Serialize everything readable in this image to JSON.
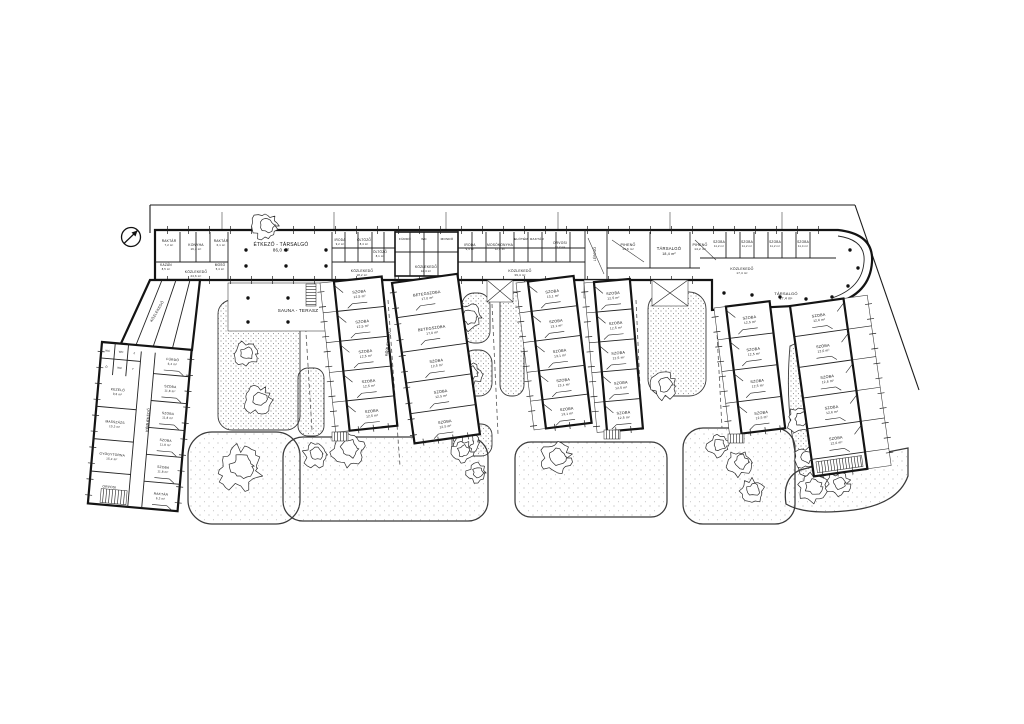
{
  "plan": {
    "ink": "#141414",
    "background": "#ffffff",
    "north_arrow": {
      "x": 131,
      "y": 237,
      "r": 9.5
    },
    "boundary": [
      [
        150,
        205,
        855,
        205
      ],
      [
        855,
        205,
        919,
        390
      ],
      [
        150,
        205,
        150,
        233
      ]
    ],
    "ext_lines": [
      [
        222,
        212,
        222,
        230
      ],
      [
        334,
        212,
        334,
        230
      ],
      [
        446,
        212,
        446,
        230
      ],
      [
        558,
        212,
        558,
        230
      ],
      [
        670,
        212,
        670,
        230
      ],
      [
        782,
        212,
        782,
        230
      ]
    ],
    "lawns": [
      {
        "x": 188,
        "y": 432,
        "w": 112,
        "h": 92,
        "rx": 24
      },
      {
        "x": 283,
        "y": 437,
        "w": 205,
        "h": 84,
        "rx": 20
      },
      {
        "x": 515,
        "y": 442,
        "w": 152,
        "h": 75,
        "rx": 16
      },
      {
        "x": 683,
        "y": 428,
        "w": 112,
        "h": 96,
        "rx": 20
      },
      {
        "path": "M786,504 Q782,478 800,470 Q846,458 888,452 L908,448 L908,476 Q898,504 854,510 Q806,516 786,504 Z"
      }
    ],
    "beds": [
      {
        "x": 218,
        "y": 300,
        "w": 82,
        "h": 130,
        "rx": 14
      },
      {
        "x": 298,
        "y": 368,
        "w": 26,
        "h": 68,
        "rx": 10
      },
      {
        "x": 462,
        "y": 293,
        "w": 28,
        "h": 50,
        "rx": 12
      },
      {
        "x": 462,
        "y": 350,
        "w": 30,
        "h": 46,
        "rx": 13
      },
      {
        "x": 452,
        "y": 424,
        "w": 40,
        "h": 32,
        "rx": 11
      },
      {
        "x": 500,
        "y": 292,
        "w": 24,
        "h": 104,
        "rx": 11
      },
      {
        "x": 648,
        "y": 292,
        "w": 58,
        "h": 104,
        "rx": 17
      },
      {
        "path": "M790,346 Q806,338 814,344 L838,470 Q816,482 800,474 Q784,414 790,346 Z"
      }
    ],
    "dashes": [
      [
        304,
        300,
        312,
        430
      ],
      [
        388,
        300,
        400,
        466
      ],
      [
        492,
        304,
        498,
        434
      ],
      [
        636,
        300,
        642,
        430
      ],
      [
        716,
        314,
        722,
        428
      ]
    ],
    "trees": [
      [
        246,
        354,
        12,
        0
      ],
      [
        258,
        400,
        14,
        0
      ],
      [
        468,
        318,
        14,
        0
      ],
      [
        470,
        374,
        12,
        0
      ],
      [
        466,
        442,
        12,
        0
      ],
      [
        664,
        386,
        13,
        0
      ],
      [
        800,
        420,
        13,
        0
      ],
      [
        806,
        458,
        11,
        0
      ],
      [
        240,
        468,
        22,
        0
      ],
      [
        315,
        455,
        12,
        0
      ],
      [
        348,
        450,
        16,
        0
      ],
      [
        462,
        452,
        11,
        0
      ],
      [
        477,
        473,
        10,
        0
      ],
      [
        556,
        458,
        15,
        0
      ],
      [
        718,
        446,
        11,
        0
      ],
      [
        740,
        463,
        13,
        0
      ],
      [
        752,
        491,
        12,
        0
      ],
      [
        812,
        488,
        15,
        0
      ],
      [
        838,
        484,
        12,
        0
      ],
      [
        265,
        226,
        14,
        1
      ]
    ],
    "slab": {
      "outline": "M155,230 L838,230 Q874,234 872,262 Q870,294 834,304 L712,310 L712,280 L155,280 Z",
      "inner_arc": "M838,236 Q866,240 864,262 Q862,288 832,298",
      "pv": [
        [
          180,
          232,
          262
        ],
        [
          196,
          232,
          262
        ],
        [
          210,
          232,
          262
        ],
        [
          228,
          232,
          280
        ],
        [
          332,
          232,
          280
        ],
        [
          345,
          232,
          262
        ],
        [
          358,
          232,
          262
        ],
        [
          372,
          232,
          262
        ],
        [
          384,
          232,
          262
        ],
        [
          395,
          230,
          280
        ],
        [
          410,
          232,
          276
        ],
        [
          424,
          232,
          276
        ],
        [
          438,
          232,
          276
        ],
        [
          458,
          230,
          280
        ],
        [
          472,
          232,
          262
        ],
        [
          486,
          232,
          262
        ],
        [
          500,
          232,
          262
        ],
        [
          514,
          232,
          262
        ],
        [
          528,
          232,
          262
        ],
        [
          542,
          232,
          262
        ],
        [
          556,
          232,
          262
        ],
        [
          570,
          232,
          262
        ],
        [
          585,
          230,
          280
        ],
        [
          607,
          230,
          280
        ],
        [
          650,
          232,
          268
        ],
        [
          690,
          232,
          268
        ],
        [
          726,
          232,
          258
        ],
        [
          740,
          232,
          258
        ],
        [
          754,
          232,
          258
        ],
        [
          768,
          232,
          258
        ],
        [
          782,
          232,
          258
        ],
        [
          796,
          232,
          258
        ],
        [
          810,
          232,
          258
        ]
      ],
      "hl": [
        [
          332,
          248,
          395
        ],
        [
          458,
          248,
          585
        ],
        [
          395,
          252,
          458
        ],
        [
          700,
          258,
          836
        ],
        [
          607,
          268,
          700
        ],
        [
          155,
          262,
          228
        ],
        [
          332,
          262,
          395
        ],
        [
          458,
          262,
          585
        ]
      ],
      "diag": [
        [
          612,
          240,
          644,
          262
        ],
        [
          695,
          240,
          716,
          260
        ],
        [
          588,
          238,
          604,
          274
        ]
      ],
      "core": {
        "x": 395,
        "y": 232,
        "w": 63,
        "h": 44
      },
      "terrace": {
        "x": 228,
        "y": 283,
        "w": 144,
        "h": 48
      },
      "tick_edges": [
        [
          155,
          230,
          838,
          230,
          21,
          8
        ],
        [
          155,
          280,
          700,
          280,
          21,
          8
        ]
      ],
      "dots": [
        [
          246,
          250
        ],
        [
          286,
          250
        ],
        [
          326,
          250
        ],
        [
          246,
          266
        ],
        [
          286,
          266
        ],
        [
          326,
          266
        ],
        [
          248,
          298
        ],
        [
          288,
          298
        ],
        [
          328,
          298
        ],
        [
          366,
          298
        ],
        [
          248,
          322
        ],
        [
          288,
          322
        ],
        [
          328,
          322
        ],
        [
          366,
          322
        ],
        [
          724,
          293
        ],
        [
          752,
          295
        ],
        [
          780,
          297
        ],
        [
          806,
          299
        ],
        [
          850,
          250
        ],
        [
          858,
          268
        ],
        [
          848,
          286
        ],
        [
          832,
          297
        ]
      ]
    },
    "entries": [
      {
        "x": 487,
        "y": 280,
        "w": 26,
        "h": 22,
        "cross": true
      },
      {
        "x": 584,
        "y": 280,
        "w": 22,
        "h": 18,
        "cross": false
      },
      {
        "x": 652,
        "y": 280,
        "w": 36,
        "h": 26,
        "cross": true
      }
    ],
    "stairs": [
      [
        306,
        284,
        10,
        22,
        "h"
      ],
      [
        332,
        432,
        16,
        9,
        "v"
      ],
      [
        604,
        430,
        16,
        9,
        "v"
      ],
      [
        728,
        434,
        16,
        9,
        "v"
      ]
    ],
    "connector": {
      "pts": "150,280 200,280 192,350 118,350",
      "parts": [
        [
          162,
          280,
          134,
          350
        ],
        [
          176,
          280,
          152,
          350
        ],
        [
          190,
          280,
          172,
          350
        ]
      ]
    },
    "left_wing": {
      "x": 102,
      "y": 342,
      "rot": 5,
      "w": 90,
      "h": 162,
      "corridor": [
        40,
        54
      ],
      "cells": {
        "w": 40,
        "h": 32,
        "cols": 3,
        "rows": 2,
        "labels": [
          "WC",
          "WC",
          "Z",
          "Ö",
          "WC",
          "T"
        ]
      },
      "left_rooms": [
        {
          "t": "KEZELŐ",
          "a": "9,6 m²"
        },
        {
          "t": "MASSZÁZS",
          "a": "10,2 m²"
        },
        {
          "t": "GYÓGYTORNA",
          "a": "15,4 m²"
        },
        {
          "t": "ORVOSI",
          "a": "11,0 m²"
        }
      ],
      "right_rooms": [
        {
          "t": "FÜRDŐ",
          "a": "6,4 m²"
        },
        {
          "t": "SZOBA",
          "a": "11,8 m²"
        },
        {
          "t": "SZOBA",
          "a": "11,8 m²"
        },
        {
          "t": "SZOBA",
          "a": "11,8 m²"
        },
        {
          "t": "SZOBA",
          "a": "11,8 m²"
        },
        {
          "t": "RAKTÁR",
          "a": "6,2 m²"
        }
      ],
      "stair": {
        "x": 12,
        "y": 146,
        "w": 26,
        "h": 14
      }
    },
    "wings": [
      {
        "id": "w2",
        "x": 320,
        "y": 283,
        "rot": -6,
        "w": 62,
        "bw": 14,
        "side": "left",
        "h": 150,
        "rooms": [
          {
            "t": "SZOBA",
            "a": "12,5 m²",
            "h": 30
          },
          {
            "t": "SZOBA",
            "a": "12,5 m²",
            "h": 30
          },
          {
            "t": "SZOBA",
            "a": "12,5 m²",
            "h": 30
          },
          {
            "t": "SZOBA",
            "a": "12,5 m²",
            "h": 30
          },
          {
            "t": "SZOBA",
            "a": "12,5 m²",
            "h": 30
          }
        ]
      },
      {
        "id": "w3",
        "x": 392,
        "y": 283,
        "rot": -8,
        "w": 66,
        "bw": 0,
        "side": "none",
        "h": 162,
        "rooms": [
          {
            "t": "BETEGSZOBA",
            "a": "17,0 m²",
            "h": 35
          },
          {
            "t": "BETEGSZOBA",
            "a": "17,0 m²",
            "h": 35
          },
          {
            "t": "SZOBA",
            "a": "12,5 m²",
            "h": 31
          },
          {
            "t": "SZOBA",
            "a": "12,5 m²",
            "h": 31
          },
          {
            "t": "SZOBA",
            "a": "12,5 m²",
            "h": 30
          }
        ]
      },
      {
        "id": "w4",
        "x": 516,
        "y": 283,
        "rot": -7,
        "w": 58,
        "bw": 12,
        "side": "left",
        "h": 148,
        "rooms": [
          {
            "t": "SZOBA",
            "a": "13,1 m²",
            "h": 30
          },
          {
            "t": "SZOBA",
            "a": "13,1 m²",
            "h": 30
          },
          {
            "t": "SZOBA",
            "a": "13,1 m²",
            "h": 30
          },
          {
            "t": "SZOBA",
            "a": "13,1 m²",
            "h": 29
          },
          {
            "t": "SZOBA",
            "a": "13,1 m²",
            "h": 29
          }
        ]
      },
      {
        "id": "w5",
        "x": 584,
        "y": 283,
        "rot": -5,
        "w": 46,
        "bw": 10,
        "side": "left",
        "h": 150,
        "rooms": [
          {
            "t": "SZOBA",
            "a": "12,5 m²",
            "h": 30
          },
          {
            "t": "SZOBA",
            "a": "12,5 m²",
            "h": 30
          },
          {
            "t": "SZOBA",
            "a": "12,5 m²",
            "h": 30
          },
          {
            "t": "SZOBA",
            "a": "12,5 m²",
            "h": 30
          },
          {
            "t": "SZOBA",
            "a": "12,5 m²",
            "h": 30
          }
        ]
      },
      {
        "id": "w6",
        "x": 714,
        "y": 308,
        "rot": -7,
        "w": 56,
        "bw": 12,
        "side": "left",
        "h": 128,
        "rooms": [
          {
            "t": "SZOBA",
            "a": "12,5 m²",
            "h": 32
          },
          {
            "t": "SZOBA",
            "a": "12,5 m²",
            "h": 32
          },
          {
            "t": "SZOBA",
            "a": "12,5 m²",
            "h": 32
          },
          {
            "t": "SZOBA",
            "a": "12,5 m²",
            "h": 32
          }
        ]
      },
      {
        "id": "w-right",
        "x": 790,
        "y": 306,
        "rot": -8,
        "w": 78,
        "bw": 24,
        "side": "right",
        "h": 172,
        "rooms": [
          {
            "t": "SZOBA",
            "a": "12,6 m²",
            "h": 31
          },
          {
            "t": "SZOBA",
            "a": "12,6 m²",
            "h": 31
          },
          {
            "t": "SZOBA",
            "a": "12,6 m²",
            "h": 31
          },
          {
            "t": "SZOBA",
            "a": "12,6 m²",
            "h": 31
          },
          {
            "t": "SZOBA",
            "a": "12,6 m²",
            "h": 31
          },
          {
            "t": "",
            "h": 17,
            "stair": true
          }
        ]
      }
    ],
    "labels": [
      {
        "t": "RAKTÁR",
        "a": "7,2 m²",
        "x": 169,
        "y": 242,
        "s": 3.3
      },
      {
        "t": "KONYHA",
        "a": "16,4 m²",
        "x": 196,
        "y": 246,
        "s": 3.4
      },
      {
        "t": "RAKTÁR",
        "a": "6,1 m²",
        "x": 221,
        "y": 242,
        "s": 3.3
      },
      {
        "t": "KAZÁN",
        "a": "8,5 m²",
        "x": 166,
        "y": 266,
        "s": 3.2
      },
      {
        "t": "MOSÓ",
        "a": "5,4 m²",
        "x": 220,
        "y": 266,
        "s": 3.2
      },
      {
        "t": "KÖZLEKEDŐ",
        "a": "24,6 m²",
        "x": 196,
        "y": 273,
        "s": 3.4
      },
      {
        "t": "ÉTKEZŐ - TÁRSALGÓ",
        "a": "86,0 m²",
        "x": 281,
        "y": 246,
        "s": 5
      },
      {
        "t": "SAUNA - TERASZ",
        "x": 298,
        "y": 312,
        "s": 4.6
      },
      {
        "t": "IRODA",
        "a": "9,2 m²",
        "x": 340,
        "y": 241,
        "s": 3.2
      },
      {
        "t": "ÖLTÖZŐ",
        "a": "8,4 m²",
        "x": 364,
        "y": 241,
        "s": 3.2
      },
      {
        "t": "ÖLTÖZŐ",
        "a": "8,1 m²",
        "x": 380,
        "y": 253,
        "s": 3.2
      },
      {
        "t": "KÖZLEKEDŐ",
        "a": "18,2 m²",
        "x": 362,
        "y": 272,
        "s": 3.4
      },
      {
        "t": "FÜRDŐ",
        "x": 405,
        "y": 240,
        "s": 3.1
      },
      {
        "t": "WC",
        "x": 424,
        "y": 240,
        "s": 3.1
      },
      {
        "t": "MOSDÓ",
        "x": 447,
        "y": 240,
        "s": 3.1
      },
      {
        "t": "KÖZLEKEDŐ",
        "a": "12,4 m²",
        "x": 426,
        "y": 268,
        "s": 3.3
      },
      {
        "t": "IRODA",
        "a": "9,4 m²",
        "x": 470,
        "y": 246,
        "s": 3.3
      },
      {
        "t": "MOSÓKONYHA",
        "a": "12,8 m²",
        "x": 500,
        "y": 246,
        "s": 3.3
      },
      {
        "t": "ELŐTÉR",
        "x": 521,
        "y": 240,
        "s": 3.1
      },
      {
        "t": "RAKTÁR",
        "x": 537,
        "y": 240,
        "s": 3.1
      },
      {
        "t": "ORVOSI",
        "a": "11,2 m²",
        "x": 560,
        "y": 244,
        "s": 3.3
      },
      {
        "t": "LÉPCSŐ",
        "x": 596,
        "y": 254,
        "r": -90,
        "s": 3.2
      },
      {
        "t": "PIHENŐ",
        "a": "14,6 m²",
        "x": 628,
        "y": 246,
        "s": 3.6
      },
      {
        "t": "TÁRSALGÓ",
        "a": "18,4 m²",
        "x": 669,
        "y": 250,
        "s": 4.2
      },
      {
        "t": "PIHENŐ",
        "a": "14,2 m²",
        "x": 700,
        "y": 246,
        "s": 3.6
      },
      {
        "t": "KÖZLEKEDŐ",
        "a": "39,4 m²",
        "x": 520,
        "y": 272,
        "s": 3.5
      },
      {
        "t": "KÖZLEKEDŐ",
        "a": "17,4 m²",
        "x": 742,
        "y": 270,
        "s": 3.5
      },
      {
        "t": "SZOBA",
        "a": "11,2 m²",
        "x": 719,
        "y": 243,
        "s": 3.2
      },
      {
        "t": "SZOBA",
        "a": "11,2 m²",
        "x": 747,
        "y": 243,
        "s": 3.2
      },
      {
        "t": "SZOBA",
        "a": "11,2 m²",
        "x": 775,
        "y": 243,
        "s": 3.2
      },
      {
        "t": "SZOBA",
        "a": "11,4 m²",
        "x": 803,
        "y": 243,
        "s": 3.2
      },
      {
        "t": "TÁRSALGÓ",
        "a": "17,4 m²",
        "x": 786,
        "y": 295,
        "s": 4
      },
      {
        "t": "KÖZLEKEDŐ",
        "a": "71,4 m²",
        "x": 389,
        "y": 344,
        "r": -83,
        "s": 3.7
      },
      {
        "t": "KÖZLEKEDŐ",
        "x": 158,
        "y": 312,
        "r": -60,
        "s": 3.6
      },
      {
        "t": "KÖZLEKEDŐ",
        "a": "38,6 m²",
        "x": 149,
        "y": 420,
        "r": -85,
        "s": 3.6
      }
    ]
  }
}
